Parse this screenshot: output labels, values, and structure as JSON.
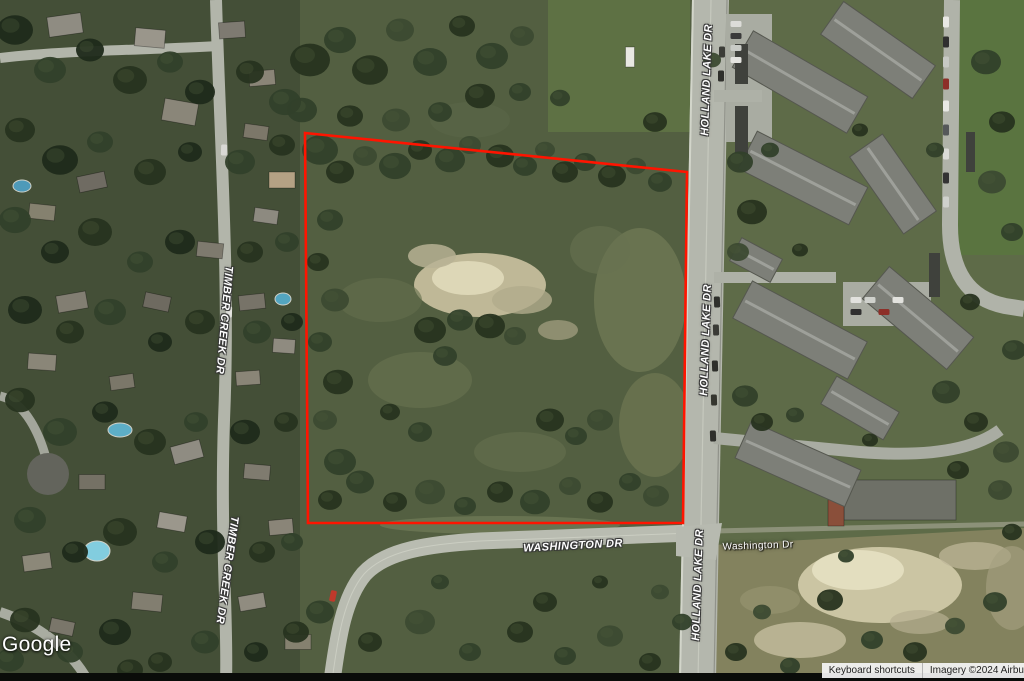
{
  "map": {
    "road_labels": [
      {
        "id": "holland-lake-dr-north",
        "text": "HOLLAND LAKE DR"
      },
      {
        "id": "holland-lake-dr-middle",
        "text": "HOLLAND LAKE DR"
      },
      {
        "id": "holland-lake-dr-south",
        "text": "HOLLAND LAKE DR"
      },
      {
        "id": "timber-creek-dr-north",
        "text": "TIMBER CREEK DR"
      },
      {
        "id": "timber-creek-dr-south",
        "text": "TIMBER CREEK DR"
      },
      {
        "id": "washington-dr",
        "text": "WASHINGTON DR"
      },
      {
        "id": "washington-dr-east",
        "text": "Washington Dr"
      }
    ],
    "parcel": {
      "points": "305,133 687,172 683,523 308,523",
      "stroke_color": "#ff1400"
    },
    "watermark": "Google",
    "attribution": {
      "keyboard_shortcuts": "Keyboard shortcuts",
      "imagery": "Imagery ©2024 Airbus"
    },
    "colors": {
      "boundary": "#ff1400",
      "woodland": "#4d5840",
      "road": "#b4b7ad",
      "sand": "#cfc8a6"
    }
  }
}
